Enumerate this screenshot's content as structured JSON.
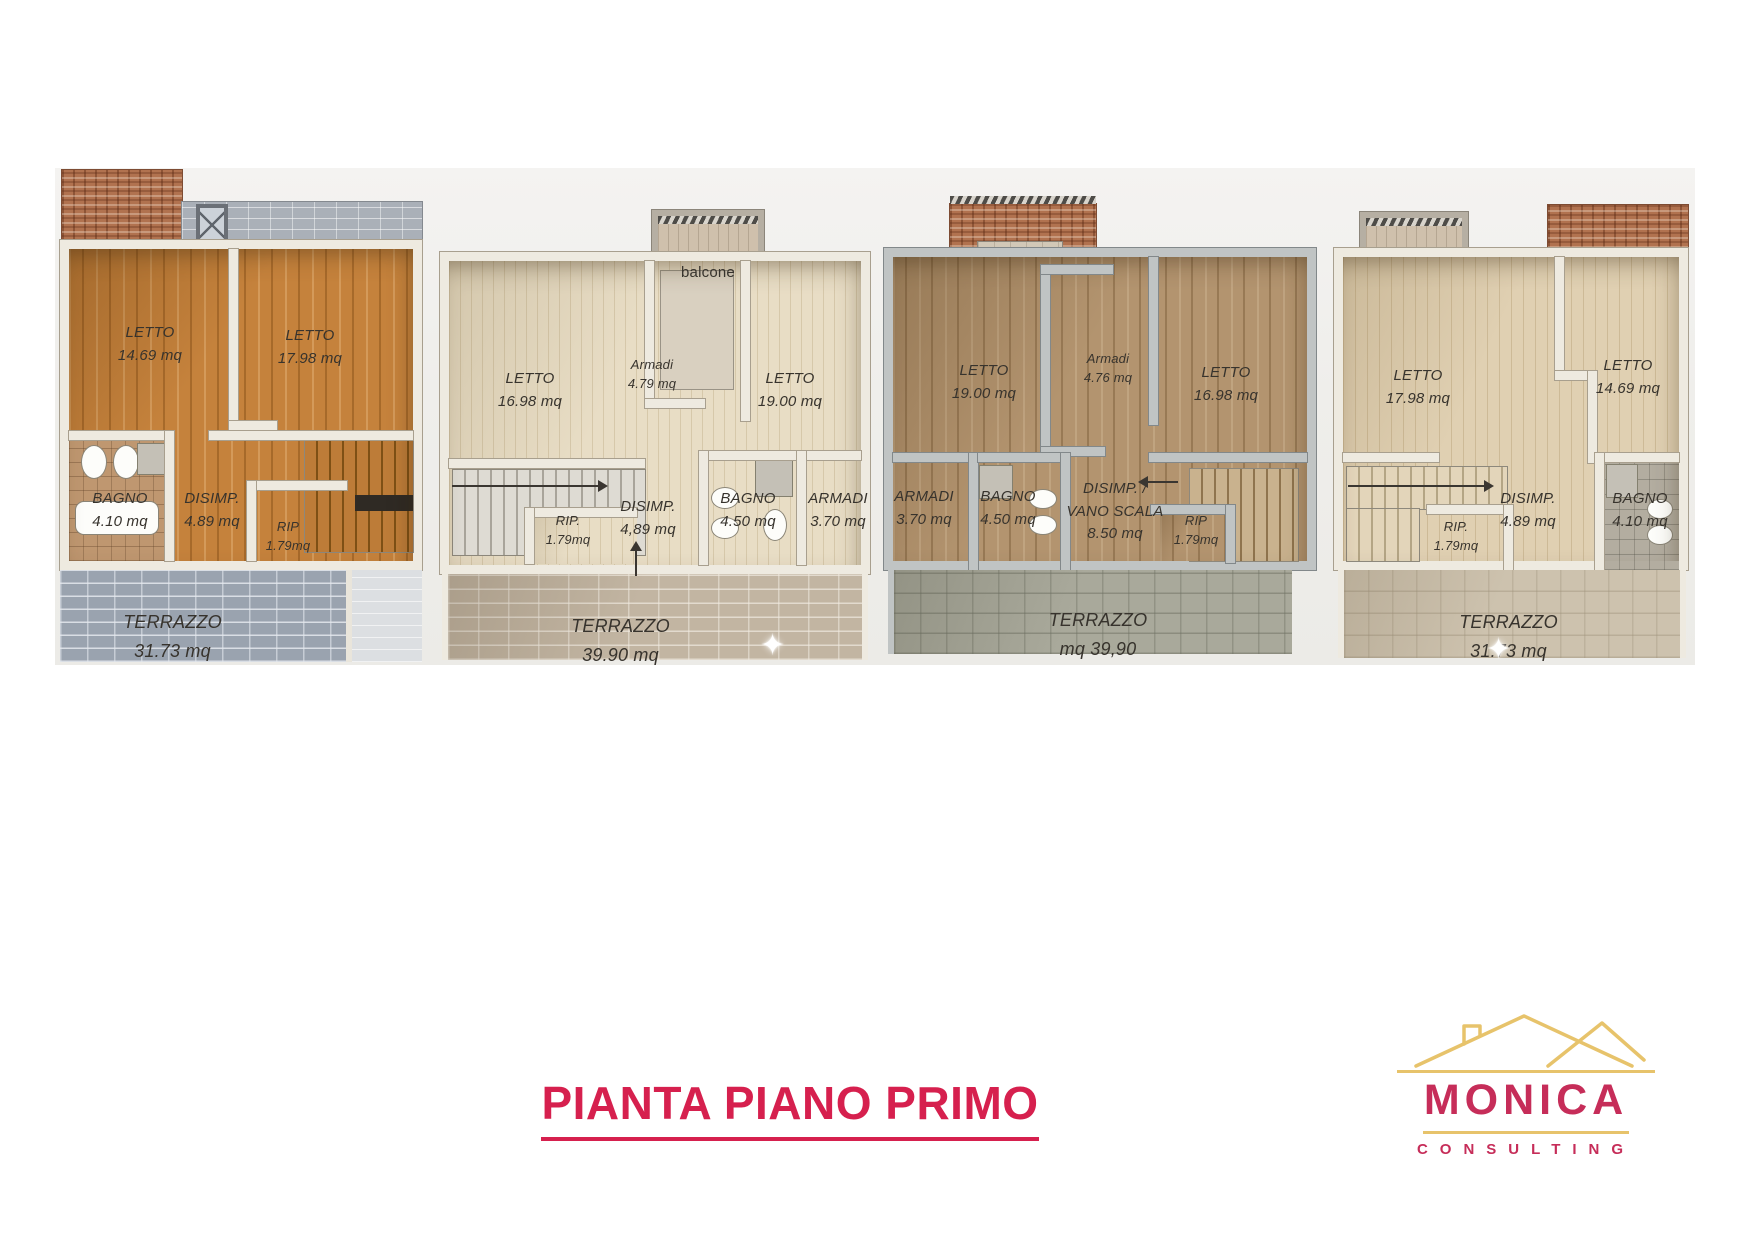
{
  "page": {
    "title_label": "PIANTA PIANO PRIMO"
  },
  "logo": {
    "name": "MONICA",
    "tagline": "CONSULTING",
    "red": "#C62D59",
    "gold": "#E7C36B"
  },
  "colors": {
    "title_red": "#D6204E"
  },
  "icons": {
    "sparkle": "✦",
    "house-roof": "gold outline of roof with chimney"
  },
  "units": [
    {
      "name": "unit-1",
      "rooms": [
        {
          "label": "LETTO",
          "area": "14.69 mq"
        },
        {
          "label": "LETTO",
          "area": "17.98 mq"
        },
        {
          "label": "BAGNO",
          "area": "4.10 mq"
        },
        {
          "label": "DISIMP.",
          "area": "4.89 mq"
        },
        {
          "label": "RIP",
          "area": "1.79mq"
        },
        {
          "label": "TERRAZZO",
          "area": "31.73 mq"
        }
      ]
    },
    {
      "name": "unit-2",
      "balcony_label": "balcone",
      "rooms": [
        {
          "label": "LETTO",
          "area": "16.98 mq"
        },
        {
          "label": "Armadi",
          "area": "4.79 mq"
        },
        {
          "label": "LETTO",
          "area": "19.00 mq"
        },
        {
          "label": "RIP.",
          "area": "1.79mq"
        },
        {
          "label": "DISIMP.",
          "area": "4,89 mq"
        },
        {
          "label": "BAGNO",
          "area": "4.50 mq"
        },
        {
          "label": "ARMADI",
          "area": "3.70 mq"
        },
        {
          "label": "TERRAZZO",
          "area": "39.90 mq"
        }
      ]
    },
    {
      "name": "unit-3",
      "rooms": [
        {
          "label": "LETTO",
          "area": "19.00 mq"
        },
        {
          "label": "Armadi",
          "area": "4.76 mq"
        },
        {
          "label": "LETTO",
          "area": "16.98 mq"
        },
        {
          "label": "ARMADI",
          "area": "3.70 mq"
        },
        {
          "label": "BAGNO",
          "area": "4.50 mq"
        },
        {
          "label": "DISIMP. /",
          "label2": "VANO SCALA",
          "area": "8.50 mq"
        },
        {
          "label": "RIP",
          "area": "1.79mq"
        },
        {
          "label": "TERRAZZO",
          "area": "mq 39,90"
        }
      ]
    },
    {
      "name": "unit-4",
      "rooms": [
        {
          "label": "LETTO",
          "area": "17.98 mq"
        },
        {
          "label": "LETTO",
          "area": "14.69 mq"
        },
        {
          "label": "DISIMP.",
          "area": "4.89 mq"
        },
        {
          "label": "BAGNO",
          "area": "4.10 mq"
        },
        {
          "label": "RIP.",
          "area": "1.79mq"
        },
        {
          "label": "TERRAZZO",
          "area": "31.73 mq"
        }
      ]
    }
  ]
}
